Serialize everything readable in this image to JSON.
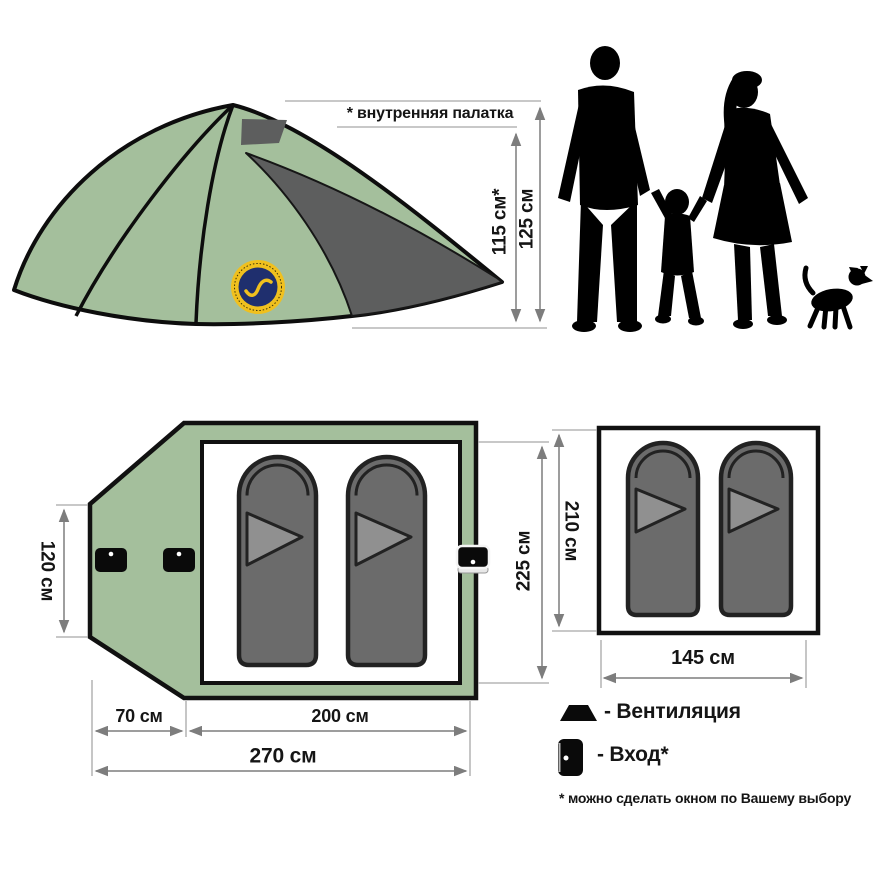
{
  "colors": {
    "tent_green": "#a4bf9c",
    "panel_gray": "#5d5e5e",
    "bag_gray": "#6b6b6b",
    "bag_flap_gray": "#909090",
    "logo_ring_yellow": "#f0c01e",
    "logo_disc_navy": "#1f2f6e",
    "dim_line_gray": "#7d7d7d",
    "silhouette_black": "#000000"
  },
  "side_view": {
    "note": "* внутренняя палатка",
    "inner_height": "115 см*",
    "total_height": "125 см"
  },
  "top_view": {
    "vestibule_width": "120 см",
    "vestibule_depth": "70 см",
    "inner_length": "200 см",
    "total_length": "270 см",
    "inner_depth": "225 см"
  },
  "inner_tent_view": {
    "depth": "210 см",
    "width": "145 см"
  },
  "legend": {
    "ventilation_label": "- Вентиляция",
    "entrance_label": "- Вход*",
    "footnote": "* можно сделать окном по Вашему выбору"
  },
  "icons": {
    "ventilation": "vent-trapezoid-icon",
    "entrance": "door-icon"
  }
}
